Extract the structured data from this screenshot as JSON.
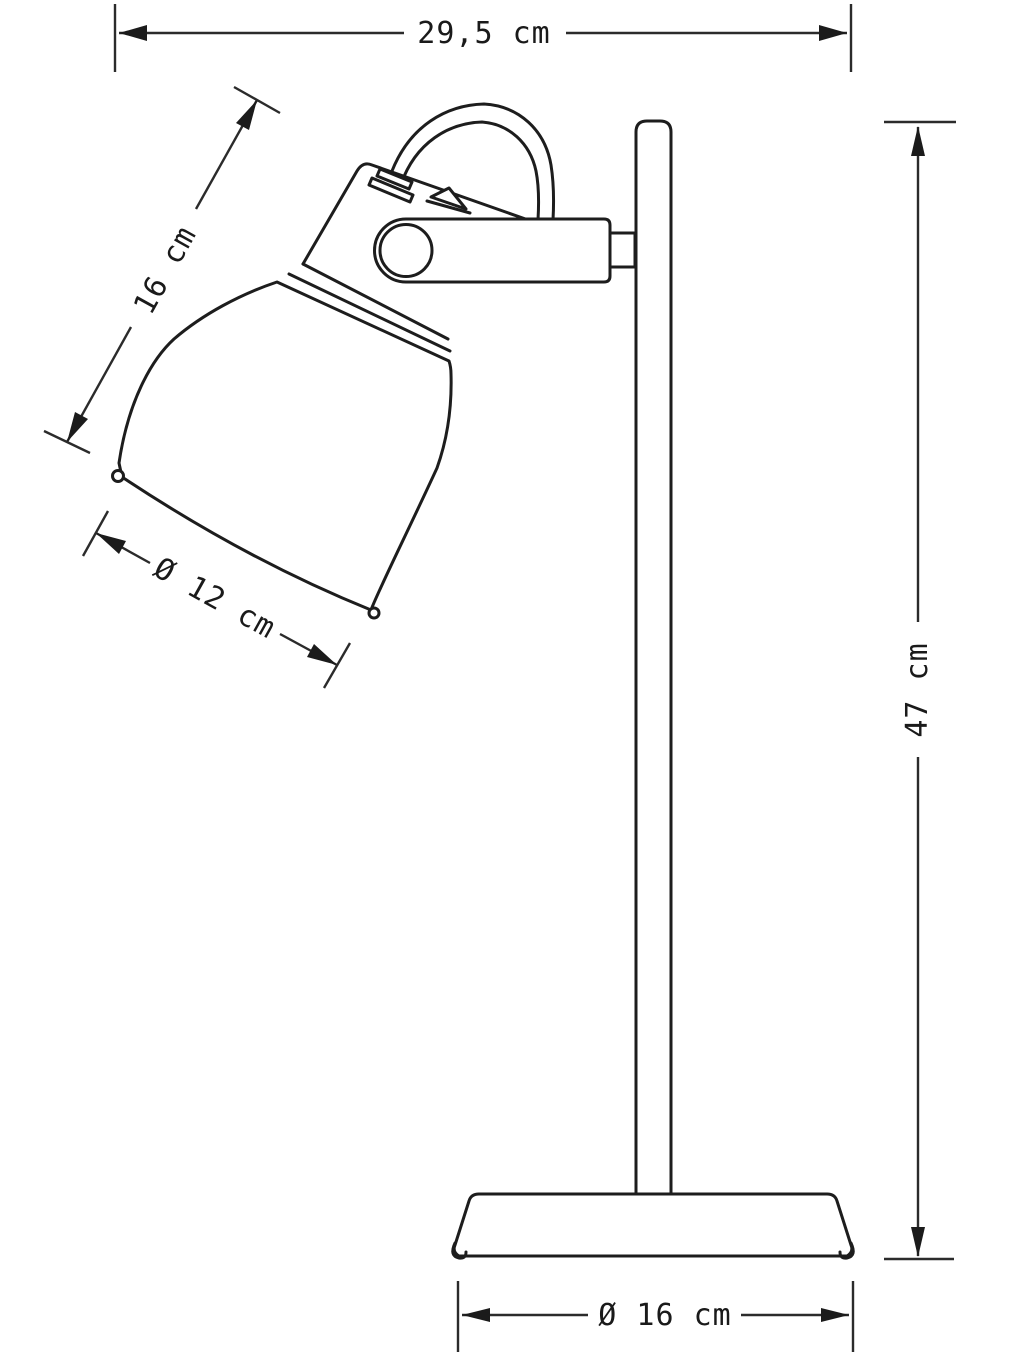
{
  "page": {
    "background": "#ffffff",
    "ink_color": "#1d1d1d",
    "dimension_color": "#2b2b2b"
  },
  "diagram": {
    "type": "product-dimension-drawing",
    "subject": "desk-lamp-side-view",
    "labels": {
      "width_top": "29,5 cm",
      "head_length": "16 cm",
      "shade_diameter": "Ø 12 cm",
      "height_right": "47 cm",
      "base_diameter": "Ø 16 cm"
    }
  }
}
